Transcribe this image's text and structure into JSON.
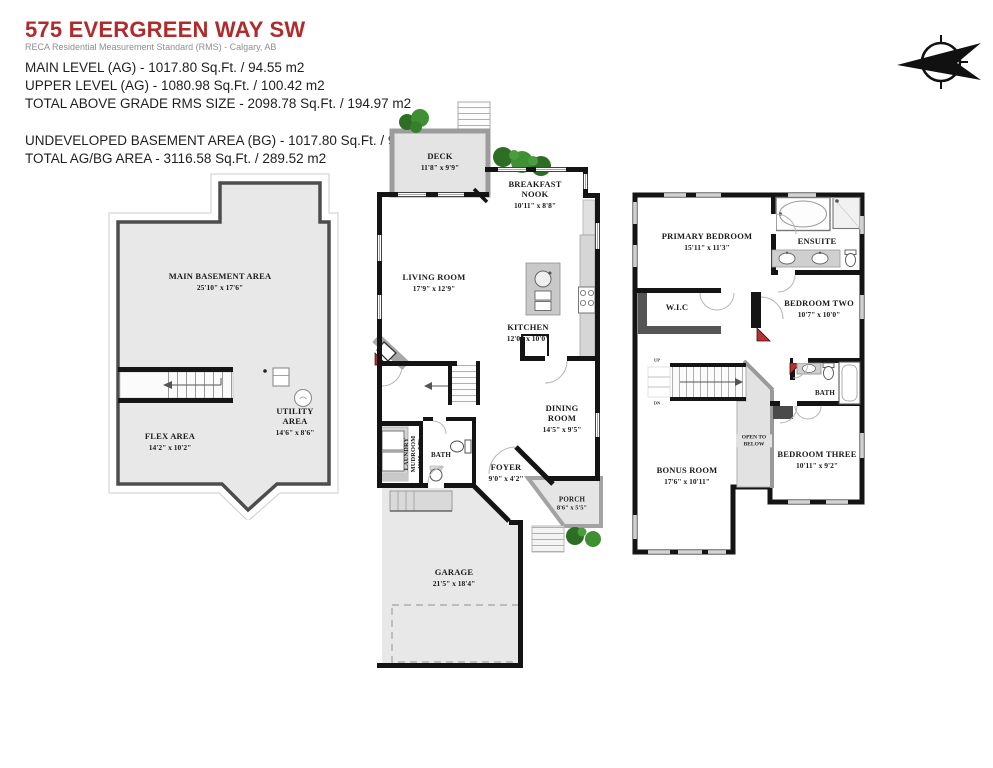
{
  "header": {
    "title": "575 EVERGREEN WAY SW",
    "subtitle": "RECA Residential Measurement Standard (RMS) - Calgary, AB",
    "ag": [
      "MAIN LEVEL (AG) - 1017.80 Sq.Ft. / 94.55 m2",
      "UPPER LEVEL (AG) - 1080.98 Sq.Ft. / 100.42 m2",
      "TOTAL ABOVE GRADE RMS SIZE - 2098.78 Sq.Ft. / 194.97 m2"
    ],
    "bg": [
      "UNDEVELOPED BASEMENT AREA (BG) - 1017.80 Sq.Ft. / 94.55 m2",
      "TOTAL AG/BG AREA - 3116.58 Sq.Ft. / 289.52 m2"
    ],
    "title_color": "#b02c2c"
  },
  "basement": {
    "main_area": {
      "name": "MAIN BASEMENT AREA",
      "dims": "25'10\" x 17'6\""
    },
    "flex": {
      "name": "FLEX AREA",
      "dims": "14'2\" x 10'2\""
    },
    "utility": {
      "name": "UTILITY AREA",
      "dims": "14'6\" x 8'6\""
    }
  },
  "main_level": {
    "deck": {
      "name": "DECK",
      "dims": "11'8\" x 9'9\""
    },
    "breakfast_nook": {
      "name": "BREAKFAST NOOK",
      "dims": "10'11\" x 8'8\""
    },
    "living_room": {
      "name": "LIVING ROOM",
      "dims": "17'9\" x 12'9\""
    },
    "kitchen": {
      "name": "KITCHEN",
      "dims": "12'0\" x 10'0\""
    },
    "dining_room": {
      "name": "DINING ROOM",
      "dims": "14'5\" x 9'5\""
    },
    "laundry": {
      "name": "LAUNDRY MUDROOM",
      "dims": "10'9\" x 5'7\""
    },
    "bath": {
      "name": "BATH"
    },
    "foyer": {
      "name": "FOYER",
      "dims": "9'0\" x 4'2\""
    },
    "porch": {
      "name": "PORCH",
      "dims": "8'6\" x 5'5\""
    },
    "garage": {
      "name": "GARAGE",
      "dims": "21'5\" x 18'4\""
    }
  },
  "upper_level": {
    "primary_bedroom": {
      "name": "PRIMARY BEDROOM",
      "dims": "15'11\" x 11'3\""
    },
    "ensuite": {
      "name": "ENSUITE"
    },
    "wic": {
      "name": "W.I.C"
    },
    "bedroom_two": {
      "name": "BEDROOM TWO",
      "dims": "10'7\" x 10'0\""
    },
    "bath": {
      "name": "BATH"
    },
    "bedroom_three": {
      "name": "BEDROOM THREE",
      "dims": "10'11\" x 9'2\""
    },
    "bonus_room": {
      "name": "BONUS ROOM",
      "dims": "17'6\" x 10'11\""
    },
    "open_to_below": {
      "name": "OPEN TO BELOW"
    },
    "stairs": {
      "up": "UP",
      "dn": "DN"
    }
  },
  "colors": {
    "wall": "#141414",
    "accent_red": "#b33330",
    "greenery": "#2f7a28",
    "floor_gray": "#e8e8e8"
  }
}
